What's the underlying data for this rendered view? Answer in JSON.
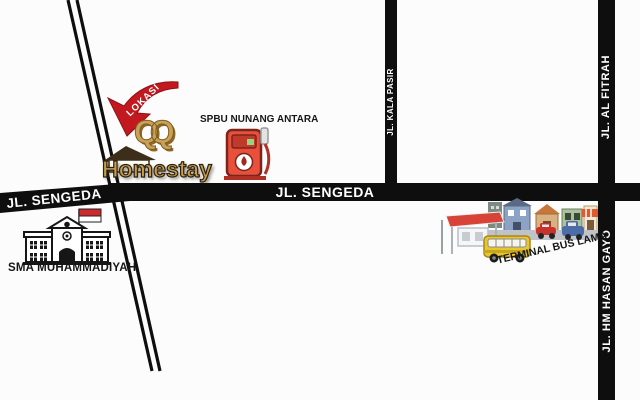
{
  "colors": {
    "background": "#fcfcfc",
    "road": "#0e0e0e",
    "road_text": "#ffffff",
    "arrow_red": "#c2181f",
    "gold": "#c79f4e",
    "flag_red": "#cd2b2b",
    "pump_red": "#e8503c",
    "bus_yellow": "#e9c52e",
    "shelter_red": "#d84338"
  },
  "roads": {
    "sengeda_left": "JL. SENGEDA",
    "sengeda_main": "JL. SENGEDA",
    "kala_pasir": "JL. KALA PASIR",
    "al_fitrah": "JL. AL FITRAH",
    "hm_hasan_gayo": "JL. HM HASAN GAYO"
  },
  "landmarks": {
    "lokasi_tag": "LOKASI",
    "homestay_monogram": "QQ",
    "homestay_name": "Homestay",
    "spbu": "SPBU NUNANG ANTARA",
    "school": "SMA MUHAMMADIYAH",
    "terminal": "TERMINAL BUS LAMA"
  }
}
